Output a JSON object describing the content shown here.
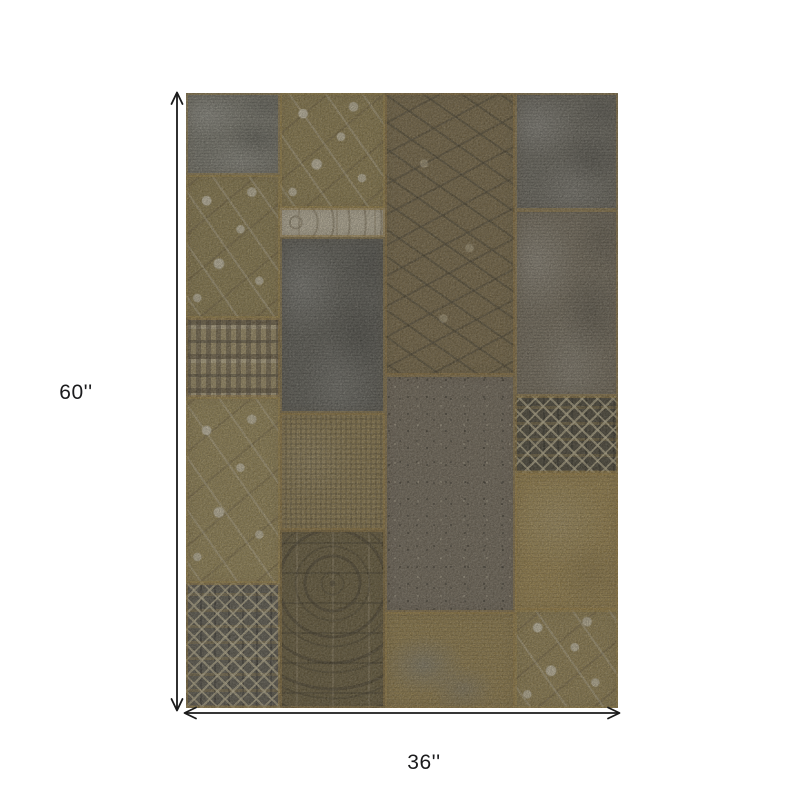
{
  "page": {
    "background": "#ffffff"
  },
  "dimensions": {
    "height_label": "60''",
    "width_label": "36''",
    "arrow_color": "#1a1a1a",
    "text_color": "#1b1b1d"
  },
  "rug": {
    "seam_color": "#b08c3e",
    "patches": [
      {
        "name": "top-left-gray",
        "pattern": "mottled",
        "x": 0,
        "y": 0,
        "w": 21.8,
        "h": 13.3,
        "base": "#7e7f77",
        "accent": "#a89a6e"
      },
      {
        "name": "left-floral",
        "pattern": "floral",
        "x": 0,
        "y": 13.3,
        "w": 21.8,
        "h": 23.3,
        "base": "#8d7a46",
        "accent": "#d9cfae"
      },
      {
        "name": "left-kilim-band",
        "pattern": "kilim",
        "x": 0,
        "y": 36.6,
        "w": 21.8,
        "h": 12.8,
        "base": "#b2a070",
        "accent": "#4e4636"
      },
      {
        "name": "left-vine-floral",
        "pattern": "floral",
        "x": 0,
        "y": 49.4,
        "w": 21.8,
        "h": 30.3,
        "base": "#9c8850",
        "accent": "#cfc3a2"
      },
      {
        "name": "left-bottom-medallion",
        "pattern": "geometric",
        "x": 0,
        "y": 79.7,
        "w": 21.8,
        "h": 20.3,
        "base": "#56534a",
        "accent": "#cfc19b"
      },
      {
        "name": "mid-left-floral",
        "pattern": "floral",
        "x": 21.8,
        "y": 0,
        "w": 24.3,
        "h": 18.7,
        "base": "#8f7b45",
        "accent": "#d6ccb0"
      },
      {
        "name": "cream-border-band",
        "pattern": "band",
        "x": 21.8,
        "y": 18.7,
        "w": 24.3,
        "h": 4.7,
        "base": "#d7ccb1",
        "accent": "#8c8265"
      },
      {
        "name": "slate-patch",
        "pattern": "mottled",
        "x": 21.8,
        "y": 23.4,
        "w": 24.3,
        "h": 28.6,
        "base": "#605f58",
        "accent": "#8a897e"
      },
      {
        "name": "tan-woven",
        "pattern": "woven",
        "x": 21.8,
        "y": 52,
        "w": 24.3,
        "h": 19,
        "base": "#a08b55",
        "accent": "#86713c"
      },
      {
        "name": "mid-ornate",
        "pattern": "ornate",
        "x": 21.8,
        "y": 71,
        "w": 24.3,
        "h": 29,
        "base": "#6f6038",
        "accent": "#473a20"
      },
      {
        "name": "olive-vine",
        "pattern": "vine",
        "x": 46.1,
        "y": 0,
        "w": 30.1,
        "h": 45.9,
        "base": "#867347",
        "accent": "#3e3723"
      },
      {
        "name": "speckled-center",
        "pattern": "speckled",
        "x": 46.1,
        "y": 45.9,
        "w": 30.1,
        "h": 38.5,
        "base": "#7d7260",
        "accent": "#514b3b"
      },
      {
        "name": "gold-gray-bottom",
        "pattern": "gold-gray",
        "x": 46.1,
        "y": 84.4,
        "w": 30.1,
        "h": 15.6,
        "base": "#a18747",
        "accent": "#7e7c74"
      },
      {
        "name": "right-top-gray",
        "pattern": "mottled",
        "x": 76.2,
        "y": 0,
        "w": 23.8,
        "h": 19,
        "base": "#6f6d63",
        "accent": "#8f8c7e"
      },
      {
        "name": "right-brown-mottled",
        "pattern": "mottled",
        "x": 76.2,
        "y": 19,
        "w": 23.8,
        "h": 30.3,
        "base": "#7b7260",
        "accent": "#9a8f75"
      },
      {
        "name": "right-dark-geometric",
        "pattern": "geometric",
        "x": 76.2,
        "y": 49.3,
        "w": 23.8,
        "h": 12.5,
        "base": "#413d2e",
        "accent": "#d2c49c"
      },
      {
        "name": "right-gold",
        "pattern": "gold",
        "x": 76.2,
        "y": 61.8,
        "w": 23.8,
        "h": 22.3,
        "base": "#a78c4c",
        "accent": "#bfa35e"
      },
      {
        "name": "right-bottom-floral",
        "pattern": "floral",
        "x": 76.2,
        "y": 84.1,
        "w": 23.8,
        "h": 15.9,
        "base": "#96804a",
        "accent": "#d3c8a8"
      }
    ]
  }
}
